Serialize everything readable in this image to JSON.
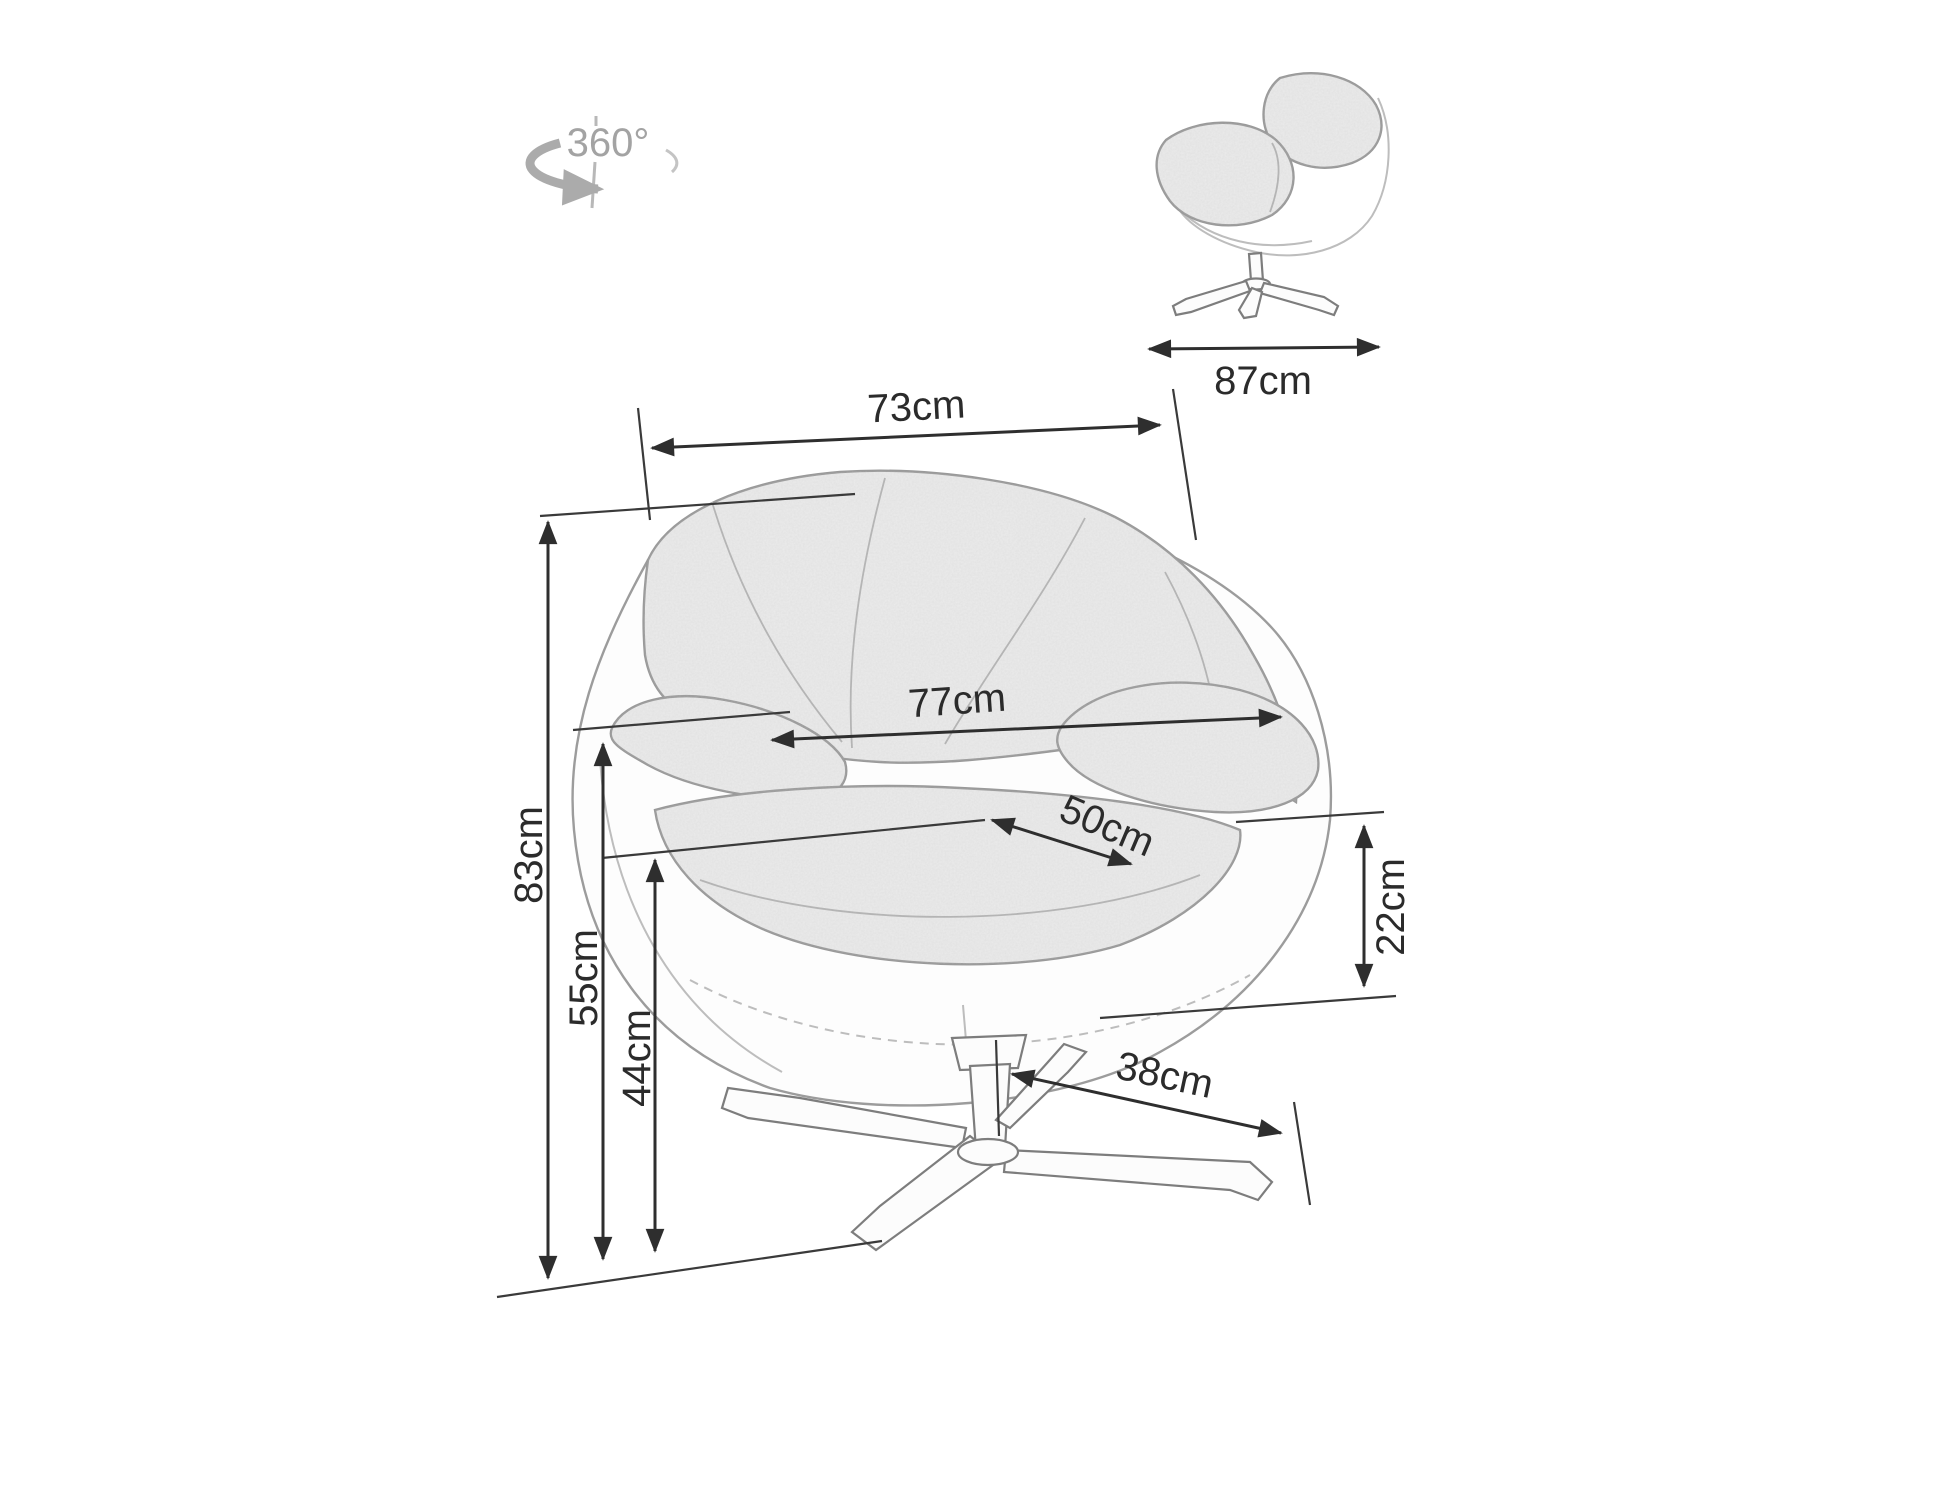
{
  "diagram": {
    "background": "#ffffff",
    "ink_color": "#2e2e2e",
    "sketch_color": "#9c9c9c",
    "icon_color": "#a3a3a3"
  },
  "rotation_icon": {
    "label": "360°"
  },
  "dimensions": {
    "overall_width": "73cm",
    "overall_depth": "87cm",
    "backrest_width": "77cm",
    "seat_depth": "50cm",
    "overall_height": "83cm",
    "armrest_height": "55cm",
    "seat_height": "44cm",
    "seat_edge_height": "22cm",
    "base_leg_span": "38cm"
  }
}
